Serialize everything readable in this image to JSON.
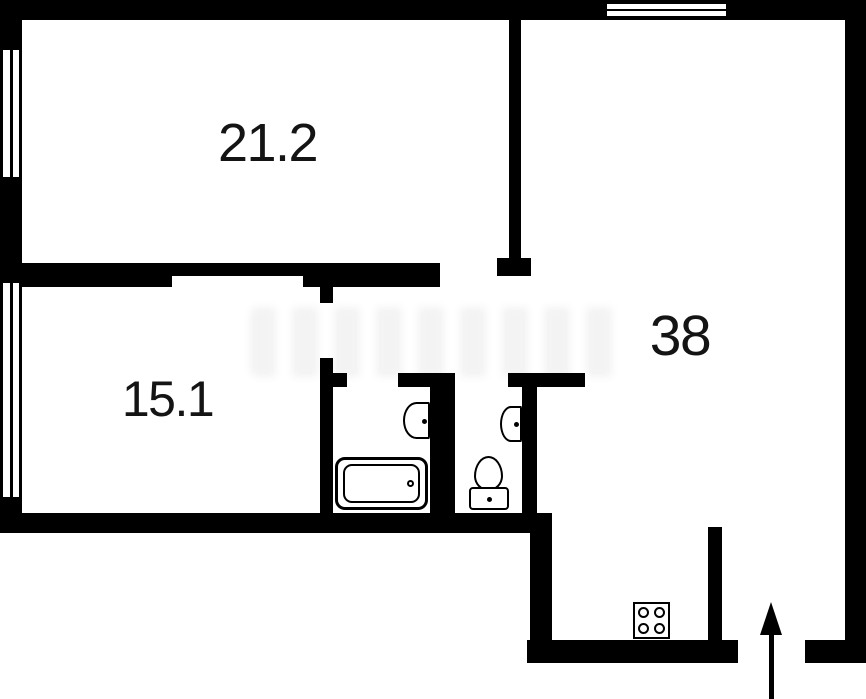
{
  "plan": {
    "type": "apartment-floor-plan",
    "rooms": [
      {
        "name": "living-room",
        "area_label": "21.2"
      },
      {
        "name": "bedroom",
        "area_label": "15.1"
      },
      {
        "name": "kitchen-living",
        "area_label": "38"
      }
    ],
    "fixtures": [
      "bathtub-icon",
      "sink-icon-bathroom",
      "sink-icon-wc",
      "toilet-icon",
      "stove-4-burner-icon",
      "entrance-arrow-icon"
    ],
    "windows": [
      "window-left-living",
      "window-left-bedroom",
      "window-top-kitchen-living"
    ],
    "colors": {
      "walls": "#000000",
      "background": "#ffffff",
      "labels": "#141414",
      "watermark": "#e9e9e9"
    }
  }
}
